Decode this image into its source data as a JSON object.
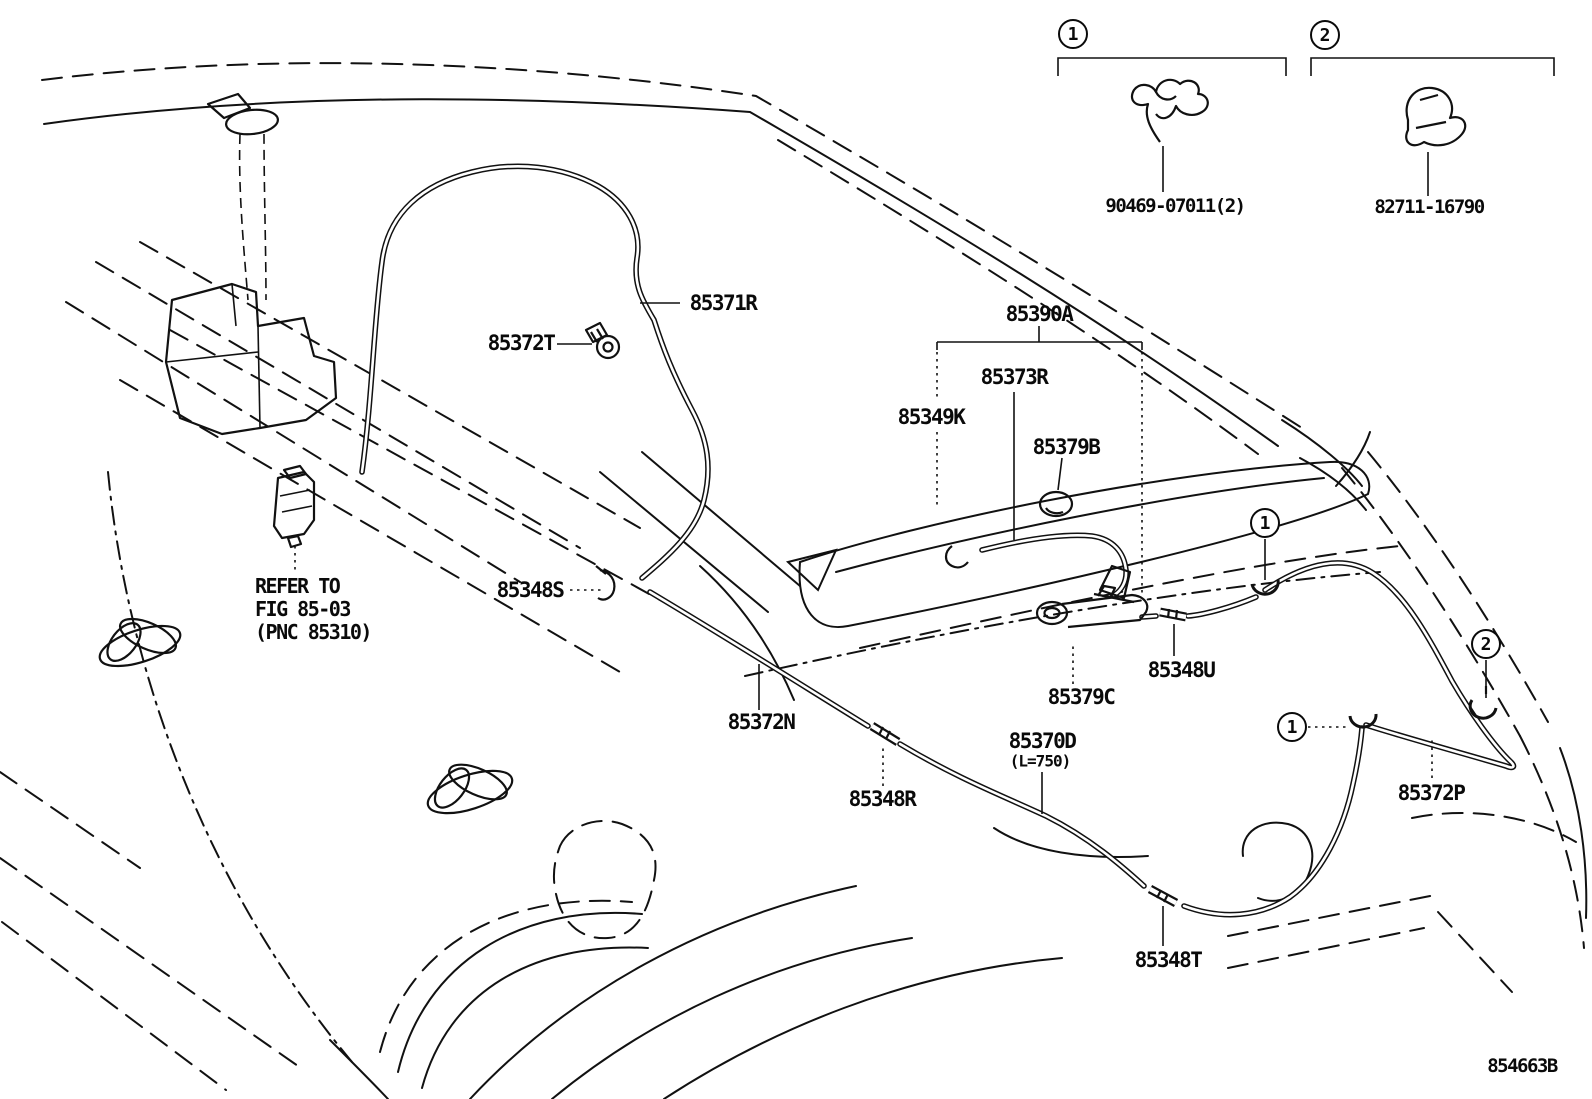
{
  "diagram": {
    "figure_code": "854663B",
    "note": {
      "line1": "REFER TO",
      "line2": "FIG 85-03",
      "line3": "(PNC 85310)"
    },
    "legend": {
      "item1": {
        "index": "1",
        "part_number": "90469-07011(2)"
      },
      "item2": {
        "index": "2",
        "part_number": "82711-16790"
      }
    },
    "callouts": {
      "c1": "1",
      "c2": "2"
    },
    "labels": {
      "hose_rear_no1": "85371R",
      "grommet_screw": "85372T",
      "nozzle_assy": "85390A",
      "hose_spoiler": "85373R",
      "packing": "85349K",
      "grommet_b": "85379B",
      "joint_s": "85348S",
      "hose_rear_no2": "85372N",
      "joint_r": "85348R",
      "nozzle_c": "85379C",
      "joint_u": "85348U",
      "hose_d": "85370D",
      "hose_d_length": "(L=750)",
      "hose_p": "85372P",
      "joint_t": "85348T"
    },
    "colors": {
      "line": "#111111",
      "background": "#ffffff"
    }
  }
}
